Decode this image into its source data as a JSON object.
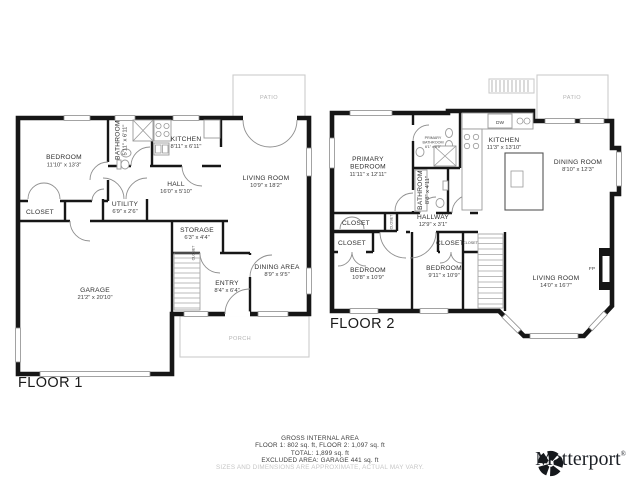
{
  "floor1": {
    "label": "FLOOR 1",
    "patio": "PATIO",
    "porch": "PORCH",
    "closet": "CLOSET",
    "bedroom": {
      "name": "BEDROOM",
      "dims": "11'10\" x 13'3\""
    },
    "bathroom": {
      "name": "BATHROOM",
      "dims": "5'11\" x 6'11\""
    },
    "kitchen": {
      "name": "KITCHEN",
      "dims": "8'11\" x 6'11\""
    },
    "living_room": {
      "name": "LIVING ROOM",
      "dims": "10'9\" x 18'2\""
    },
    "hall": {
      "name": "HALL",
      "dims": "16'0\" x 5'10\""
    },
    "utility": {
      "name": "UTILITY",
      "dims": "6'9\" x 2'6\""
    },
    "storage": {
      "name": "STORAGE",
      "dims": "6'3\" x 4'4\""
    },
    "entry": {
      "name": "ENTRY",
      "dims": "8'4\" x 6'4\""
    },
    "dining_area": {
      "name": "DINING AREA",
      "dims": "8'9\" x 9'5\""
    },
    "garage": {
      "name": "GARAGE",
      "dims": "21'2\" x 20'10\""
    }
  },
  "floor2": {
    "label": "FLOOR 2",
    "patio": "PATIO",
    "closet": "CLOSET",
    "dw": "DW",
    "fp": "FP",
    "primary_bedroom": {
      "line1": "PRIMARY",
      "line2": "BEDROOM",
      "dims": "11'11\" x 12'11\""
    },
    "primary_bathroom": {
      "line1": "PRIMARY",
      "line2": "BATHROOM",
      "dims": "6'1\" x 6'5\""
    },
    "kitchen": {
      "name": "KITCHEN",
      "dims": "11'3\" x 13'10\""
    },
    "dining_room": {
      "name": "DINING ROOM",
      "dims": "8'10\" x 12'3\""
    },
    "bathroom": {
      "name": "BATHROOM",
      "dims": "8'8\" x 4'11\""
    },
    "hallway": {
      "name": "HALLWAY",
      "dims": "12'9\" x 3'1\""
    },
    "bedroom_left": {
      "name": "BEDROOM",
      "dims": "10'8\" x 10'9\""
    },
    "bedroom_right": {
      "name": "BEDROOM",
      "dims": "9'11\" x 10'9\""
    },
    "living_room": {
      "name": "LIVING ROOM",
      "dims": "14'0\" x 16'7\""
    }
  },
  "footer": {
    "line1": "GROSS INTERNAL AREA",
    "line2": "FLOOR 1: 802 sq. ft, FLOOR 2: 1,097 sq. ft",
    "line3": "TOTAL: 1,899 sq. ft",
    "line4": "EXCLUDED AREA: GARAGE 441 sq. ft",
    "disclaimer": "SIZES AND DIMENSIONS ARE APPROXIMATE, ACTUAL MAY VARY."
  },
  "logo": {
    "name": "Matterport",
    "mark": "®"
  }
}
